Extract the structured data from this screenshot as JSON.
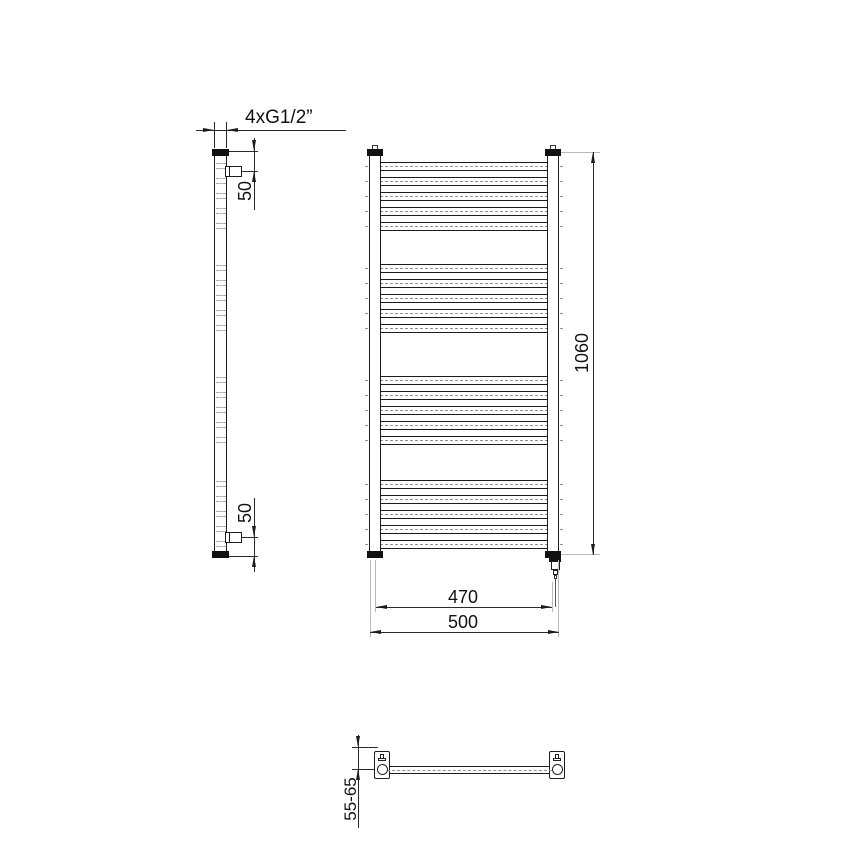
{
  "labels": {
    "connection": "4xG1/2”",
    "offset_top": "50",
    "offset_bottom": "50",
    "height": "1060",
    "spacing": "470",
    "width": "500",
    "wall_distance": "55-65"
  },
  "front_view": {
    "rung_groups": 4,
    "rungs_per_group": 5,
    "rung_centers": [
      166,
      181,
      196,
      211,
      226,
      268,
      283,
      298,
      313,
      328,
      380,
      395,
      410,
      425,
      440,
      484,
      499,
      514,
      529,
      544
    ]
  },
  "colors": {
    "line": "#1c1c1c",
    "dimension": "#2a2a2a",
    "hidden": "#8f8f8f",
    "projection": "#b9b9b9",
    "background": "#ffffff"
  }
}
